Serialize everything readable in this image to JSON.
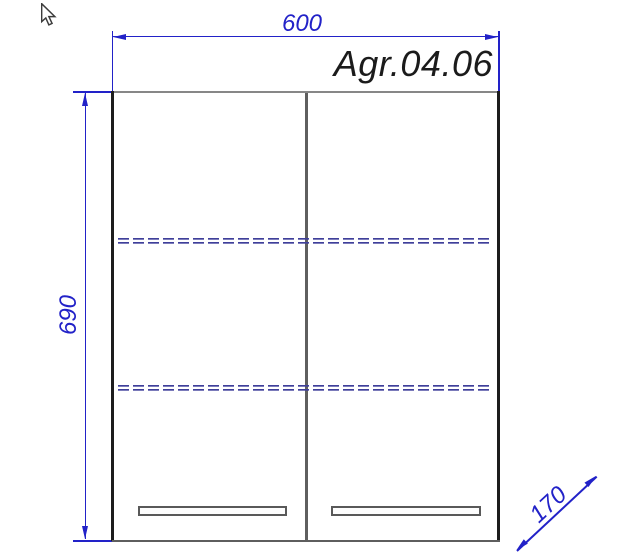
{
  "cursor": {
    "icon": "arrow-pointer-icon"
  },
  "drawing": {
    "model_label": "Agr.04.06",
    "dimensions": {
      "width": "600",
      "height": "690",
      "depth": "170"
    },
    "structure": {
      "doors": 2,
      "shelves": 2,
      "handles": 2
    },
    "colors": {
      "dimension_blue": "#2222c8",
      "shelf_dash_blue": "#3f3f9a",
      "outline_dark": "#1d1d1d",
      "outline_gray": "#878787",
      "label_black": "#1b1b1b"
    }
  }
}
